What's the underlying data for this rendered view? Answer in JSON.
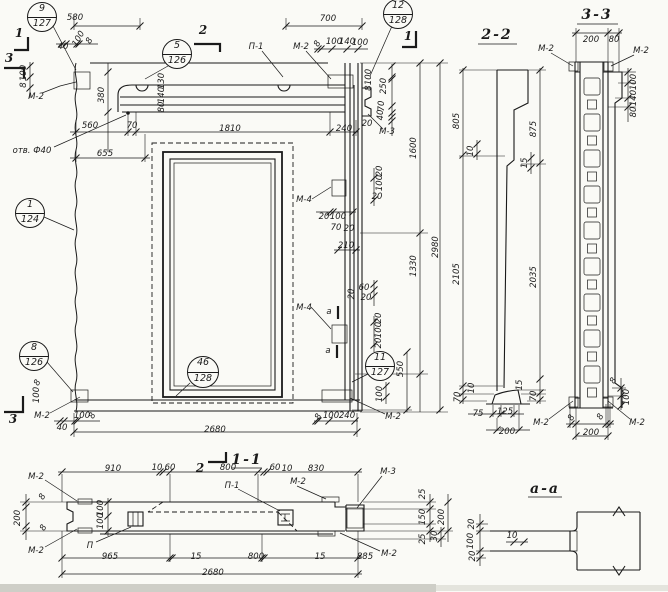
{
  "colors": {
    "ink": "#1a1a1a",
    "paper": "#fafaf6"
  },
  "callouts": [
    {
      "top": "9",
      "bottom": "127",
      "x": 42,
      "y": 17,
      "r": 15
    },
    {
      "top": "5",
      "bottom": "126",
      "x": 177,
      "y": 54,
      "r": 15
    },
    {
      "top": "12",
      "bottom": "128",
      "x": 398,
      "y": 14,
      "r": 15
    },
    {
      "top": "1",
      "bottom": "124",
      "x": 30,
      "y": 213,
      "r": 15
    },
    {
      "top": "8",
      "bottom": "126",
      "x": 34,
      "y": 356,
      "r": 15
    },
    {
      "top": "46",
      "bottom": "128",
      "x": 203,
      "y": 372,
      "r": 16
    },
    {
      "top": "11",
      "bottom": "127",
      "x": 380,
      "y": 366,
      "r": 15
    }
  ],
  "labels": [
    {
      "t": "580",
      "x": 75,
      "y": 18
    },
    {
      "t": "700",
      "x": 328,
      "y": 19
    },
    {
      "t": "8",
      "x": 318,
      "y": 44,
      "r": 60
    },
    {
      "t": "100",
      "x": 334,
      "y": 42
    },
    {
      "t": "140",
      "x": 347,
      "y": 42
    },
    {
      "t": "100",
      "x": 360,
      "y": 43
    },
    {
      "t": "П-1",
      "x": 256,
      "y": 47,
      "n": "weld-label"
    },
    {
      "t": "М-2",
      "x": 301,
      "y": 47,
      "n": "embed-label"
    },
    {
      "t": "40",
      "x": 63,
      "y": 47
    },
    {
      "t": "100",
      "x": 79,
      "y": 39,
      "r": 60
    },
    {
      "t": "8",
      "x": 90,
      "y": 41,
      "r": 60
    },
    {
      "t": "100",
      "x": 24,
      "y": 73,
      "r": 90
    },
    {
      "t": "8",
      "x": 24,
      "y": 85,
      "r": 90
    },
    {
      "t": "М-2",
      "x": 36,
      "y": 97,
      "n": "embed-label"
    },
    {
      "t": "380",
      "x": 102,
      "y": 95,
      "r": 90
    },
    {
      "t": "130",
      "x": 162,
      "y": 81,
      "r": 90
    },
    {
      "t": "140",
      "x": 162,
      "y": 95,
      "r": 90
    },
    {
      "t": "80",
      "x": 162,
      "y": 107,
      "r": 90
    },
    {
      "t": "70",
      "x": 132,
      "y": 126
    },
    {
      "t": "560",
      "x": 90,
      "y": 126
    },
    {
      "t": "1810",
      "x": 230,
      "y": 129
    },
    {
      "t": "240",
      "x": 344,
      "y": 129
    },
    {
      "t": "отв. Ф40",
      "x": 32,
      "y": 151,
      "n": "hole-label"
    },
    {
      "t": "655",
      "x": 105,
      "y": 154
    },
    {
      "t": "100",
      "x": 369,
      "y": 77,
      "r": 90
    },
    {
      "t": "8",
      "x": 369,
      "y": 88,
      "r": 90
    },
    {
      "t": "250",
      "x": 384,
      "y": 86,
      "r": 90
    },
    {
      "t": "70",
      "x": 382,
      "y": 106,
      "r": 90
    },
    {
      "t": "40",
      "x": 381,
      "y": 115,
      "r": 90
    },
    {
      "t": "20",
      "x": 367,
      "y": 124
    },
    {
      "t": "М-3",
      "x": 387,
      "y": 132,
      "n": "embed-label"
    },
    {
      "t": "1600",
      "x": 414,
      "y": 148,
      "r": 90
    },
    {
      "t": "20",
      "x": 380,
      "y": 171,
      "r": 90
    },
    {
      "t": "100",
      "x": 380,
      "y": 183,
      "r": 90
    },
    {
      "t": "20",
      "x": 377,
      "y": 197
    },
    {
      "t": "М-4",
      "x": 304,
      "y": 200,
      "n": "embed-label"
    },
    {
      "t": "20",
      "x": 324,
      "y": 217
    },
    {
      "t": "100",
      "x": 338,
      "y": 217
    },
    {
      "t": "70",
      "x": 336,
      "y": 228
    },
    {
      "t": "20",
      "x": 349,
      "y": 229
    },
    {
      "t": "210",
      "x": 346,
      "y": 246
    },
    {
      "t": "1330",
      "x": 414,
      "y": 266,
      "r": 90
    },
    {
      "t": "2980",
      "x": 436,
      "y": 247,
      "r": 90
    },
    {
      "t": "60",
      "x": 364,
      "y": 288
    },
    {
      "t": "20",
      "x": 366,
      "y": 298
    },
    {
      "t": "20",
      "x": 352,
      "y": 294,
      "r": 90
    },
    {
      "t": "М-4",
      "x": 304,
      "y": 308,
      "n": "embed-label"
    },
    {
      "t": "а",
      "x": 329,
      "y": 312,
      "n": "section-a-mark"
    },
    {
      "t": "а",
      "x": 328,
      "y": 351,
      "n": "section-a-mark"
    },
    {
      "t": "20",
      "x": 379,
      "y": 318,
      "r": 90
    },
    {
      "t": "100",
      "x": 379,
      "y": 330,
      "r": 90
    },
    {
      "t": "20",
      "x": 379,
      "y": 343,
      "r": 90
    },
    {
      "t": "550",
      "x": 401,
      "y": 369,
      "r": 90
    },
    {
      "t": "100",
      "x": 380,
      "y": 394,
      "r": 90
    },
    {
      "t": "8",
      "x": 319,
      "y": 417,
      "r": 60
    },
    {
      "t": "100",
      "x": 331,
      "y": 416
    },
    {
      "t": "240",
      "x": 347,
      "y": 416
    },
    {
      "t": "М-2",
      "x": 393,
      "y": 417,
      "n": "embed-label"
    },
    {
      "t": "М-2",
      "x": 42,
      "y": 416,
      "n": "embed-label"
    },
    {
      "t": "40",
      "x": 62,
      "y": 428
    },
    {
      "t": "100",
      "x": 82,
      "y": 416
    },
    {
      "t": "8",
      "x": 93,
      "y": 416,
      "r": 60
    },
    {
      "t": "2680",
      "x": 215,
      "y": 430
    },
    {
      "t": "100",
      "x": 37,
      "y": 395,
      "r": 90
    },
    {
      "t": "8",
      "x": 38,
      "y": 383,
      "r": 60
    },
    {
      "t": "2-2",
      "x": 497,
      "y": 35,
      "c": "title",
      "n": "section-title-2-2"
    },
    {
      "t": "805",
      "x": 457,
      "y": 121,
      "r": 90
    },
    {
      "t": "875",
      "x": 534,
      "y": 129,
      "r": 90
    },
    {
      "t": "10",
      "x": 471,
      "y": 151,
      "r": 90
    },
    {
      "t": "15",
      "x": 525,
      "y": 163,
      "r": 90
    },
    {
      "t": "2105",
      "x": 457,
      "y": 274,
      "r": 90
    },
    {
      "t": "2035",
      "x": 534,
      "y": 277,
      "r": 90
    },
    {
      "t": "70",
      "x": 458,
      "y": 397,
      "r": 90
    },
    {
      "t": "10",
      "x": 472,
      "y": 388,
      "r": 90
    },
    {
      "t": "15",
      "x": 520,
      "y": 385,
      "r": 90
    },
    {
      "t": "70",
      "x": 534,
      "y": 396,
      "r": 90
    },
    {
      "t": "75",
      "x": 478,
      "y": 414
    },
    {
      "t": "125",
      "x": 505,
      "y": 412
    },
    {
      "t": "200",
      "x": 507,
      "y": 432
    },
    {
      "t": "3-3",
      "x": 597,
      "y": 15,
      "c": "title",
      "n": "section-title-3-3"
    },
    {
      "t": "200",
      "x": 591,
      "y": 40
    },
    {
      "t": "80",
      "x": 614,
      "y": 40
    },
    {
      "t": "М-2",
      "x": 546,
      "y": 49,
      "n": "embed-label"
    },
    {
      "t": "М-2",
      "x": 641,
      "y": 51,
      "n": "embed-label"
    },
    {
      "t": "100",
      "x": 634,
      "y": 82,
      "r": 90
    },
    {
      "t": "140",
      "x": 634,
      "y": 98,
      "r": 90
    },
    {
      "t": "80",
      "x": 634,
      "y": 112,
      "r": 90
    },
    {
      "t": "8",
      "x": 614,
      "y": 381,
      "r": 60
    },
    {
      "t": "100",
      "x": 627,
      "y": 397,
      "r": 90
    },
    {
      "t": "М-2",
      "x": 541,
      "y": 423,
      "n": "embed-label"
    },
    {
      "t": "8",
      "x": 572,
      "y": 418,
      "r": 60
    },
    {
      "t": "8",
      "x": 601,
      "y": 417,
      "r": 60
    },
    {
      "t": "М-2",
      "x": 637,
      "y": 423,
      "n": "embed-label"
    },
    {
      "t": "200",
      "x": 591,
      "y": 433
    },
    {
      "t": "1-1",
      "x": 247,
      "y": 460,
      "c": "title",
      "n": "section-title-1-1"
    },
    {
      "t": "910",
      "x": 113,
      "y": 469
    },
    {
      "t": "10",
      "x": 157,
      "y": 468
    },
    {
      "t": "60",
      "x": 170,
      "y": 468
    },
    {
      "t": "800",
      "x": 228,
      "y": 468
    },
    {
      "t": "60",
      "x": 275,
      "y": 468
    },
    {
      "t": "10",
      "x": 287,
      "y": 469
    },
    {
      "t": "830",
      "x": 316,
      "y": 469
    },
    {
      "t": "М-3",
      "x": 388,
      "y": 472,
      "n": "embed-label"
    },
    {
      "t": "М-2",
      "x": 36,
      "y": 477,
      "n": "embed-label"
    },
    {
      "t": "П-1",
      "x": 232,
      "y": 486,
      "n": "weld-label"
    },
    {
      "t": "М-2",
      "x": 298,
      "y": 482,
      "n": "embed-label"
    },
    {
      "t": "8",
      "x": 43,
      "y": 497,
      "r": 60
    },
    {
      "t": "200",
      "x": 18,
      "y": 518,
      "r": 90
    },
    {
      "t": "8",
      "x": 44,
      "y": 528,
      "r": 60
    },
    {
      "t": "100",
      "x": 101,
      "y": 508,
      "r": 90
    },
    {
      "t": "100",
      "x": 101,
      "y": 521,
      "r": 90
    },
    {
      "t": "П",
      "x": 90,
      "y": 546,
      "n": "embed-label"
    },
    {
      "t": "М-2",
      "x": 36,
      "y": 551,
      "n": "embed-label"
    },
    {
      "t": "25",
      "x": 423,
      "y": 494,
      "r": 90
    },
    {
      "t": "150",
      "x": 423,
      "y": 517,
      "r": 90
    },
    {
      "t": "25",
      "x": 423,
      "y": 539,
      "r": 90
    },
    {
      "t": "200",
      "x": 442,
      "y": 517,
      "r": 90
    },
    {
      "t": "30",
      "x": 435,
      "y": 536,
      "r": 90
    },
    {
      "t": "М-2",
      "x": 389,
      "y": 554,
      "n": "embed-label"
    },
    {
      "t": "965",
      "x": 110,
      "y": 557
    },
    {
      "t": "15",
      "x": 196,
      "y": 557
    },
    {
      "t": "800",
      "x": 256,
      "y": 557
    },
    {
      "t": "15",
      "x": 320,
      "y": 557
    },
    {
      "t": "885",
      "x": 365,
      "y": 557
    },
    {
      "t": "2680",
      "x": 213,
      "y": 573
    },
    {
      "t": "а-а",
      "x": 545,
      "y": 489,
      "c": "title",
      "n": "section-title-a-a"
    },
    {
      "t": "20",
      "x": 472,
      "y": 524,
      "r": 90
    },
    {
      "t": "100",
      "x": 471,
      "y": 541,
      "r": 90
    },
    {
      "t": "20",
      "x": 473,
      "y": 556,
      "r": 90
    },
    {
      "t": "10",
      "x": 512,
      "y": 536
    },
    {
      "t": "1",
      "x": 19,
      "y": 33,
      "c": "mark",
      "n": "cut-mark-1"
    },
    {
      "t": "3",
      "x": 9,
      "y": 58,
      "c": "mark",
      "n": "cut-mark-3"
    },
    {
      "t": "2",
      "x": 203,
      "y": 30,
      "c": "mark",
      "n": "cut-mark-2"
    },
    {
      "t": "1",
      "x": 408,
      "y": 36,
      "c": "mark",
      "n": "cut-mark-1"
    },
    {
      "t": "3",
      "x": 13,
      "y": 419,
      "c": "mark",
      "n": "cut-mark-3"
    },
    {
      "t": "2",
      "x": 200,
      "y": 468,
      "c": "mark",
      "n": "cut-mark-2"
    }
  ]
}
